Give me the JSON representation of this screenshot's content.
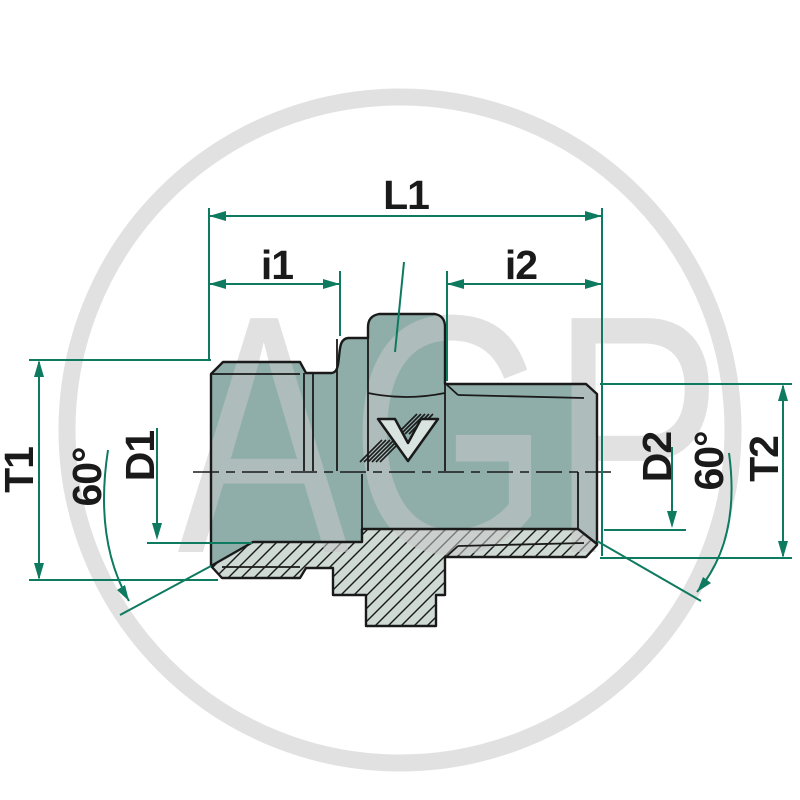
{
  "drawing": {
    "title": "hydraulic straight adapter fitting - dimensioned section drawing",
    "watermark": {
      "text": "AGP"
    },
    "logo": {
      "name": "voss-v-logo"
    },
    "dimensions": {
      "l1": "L1",
      "i1": "i1",
      "i2": "i2",
      "t1": "T1",
      "d1": "D1",
      "angle_left": "60°",
      "d2": "D2",
      "angle_right": "60°",
      "t2": "T2"
    },
    "colors": {
      "body": "#8FAEAA",
      "section": "#CFDAD5",
      "logo_fill": "#D9E4E0",
      "line": "#1A1A1A",
      "dim": "#0E7A60",
      "watermark": "#C9C9C9"
    }
  }
}
